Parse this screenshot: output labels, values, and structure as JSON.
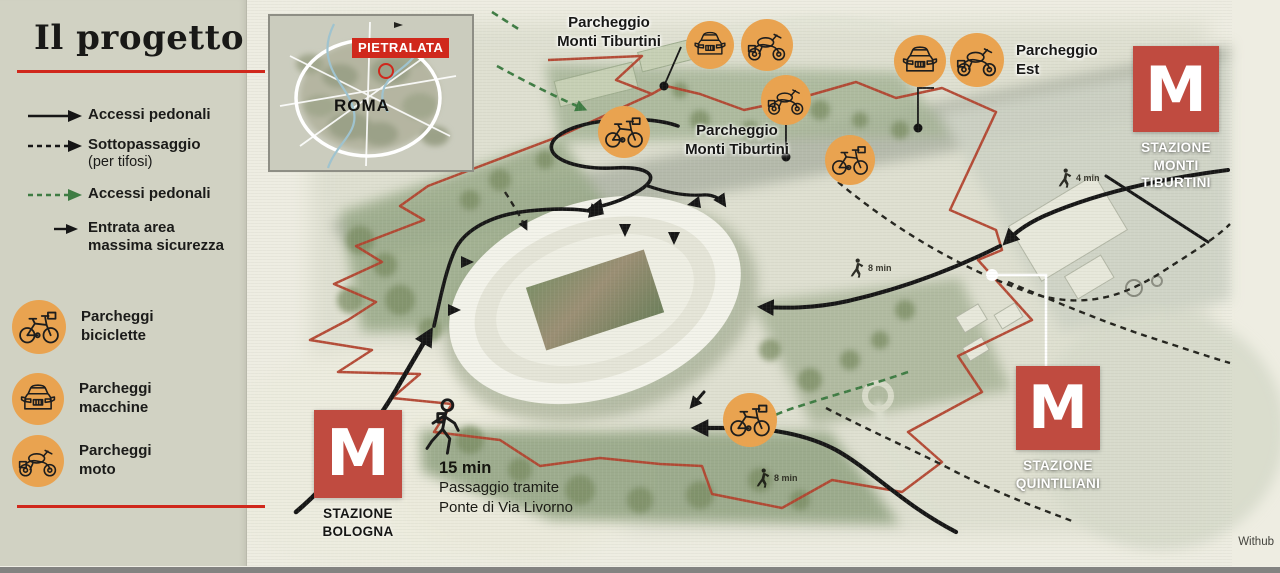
{
  "title": "Il progetto",
  "credit": "Withub",
  "colors": {
    "accent_red": "#d0281c",
    "metro_red": "#c04b40",
    "icon_orange": "#e9a350",
    "green_dash": "#3e7c43",
    "sidebar_bg": "#d1d2c3"
  },
  "legend": {
    "routes": [
      {
        "style": "solid-black-arrow",
        "label": "Accessi pedonali"
      },
      {
        "style": "dashed-black-arrow",
        "label": "Sottopassaggio",
        "sublabel": "(per tifosi)"
      },
      {
        "style": "dashed-green-arrow",
        "label": "Accessi pedonali"
      },
      {
        "style": "small-black-arrow",
        "line1": "Entrata area",
        "line2": "massima sicurezza"
      }
    ],
    "parking": [
      {
        "icon": "bicycle-icon",
        "line1": "Parcheggi",
        "line2": "biciclette"
      },
      {
        "icon": "car-icon",
        "line1": "Parcheggi",
        "line2": "macchine"
      },
      {
        "icon": "motorcycle-icon",
        "line1": "Parcheggi",
        "line2": "moto"
      }
    ]
  },
  "inset": {
    "district": "PIETRALATA",
    "city": "ROMA"
  },
  "map": {
    "labels": [
      {
        "line1": "Parcheggio",
        "line2": "Monti Tiburtini"
      },
      {
        "line1": "Parcheggio",
        "line2": "Monti Tiburtini"
      },
      {
        "line1": "Parcheggio",
        "line2": "Est"
      }
    ],
    "stations": [
      {
        "symbol": "M",
        "lines": [
          "STAZIONE",
          "MONTI",
          "TIBURTINI"
        ]
      },
      {
        "symbol": "M",
        "lines": [
          "STAZIONE",
          "QUINTILIANI"
        ]
      },
      {
        "symbol": "M",
        "lines": [
          "STAZIONE",
          "BOLOGNA"
        ]
      }
    ],
    "walk_note": {
      "time": "15 min",
      "line1": "Passaggio tramite",
      "line2": "Ponte di Via Livorno"
    },
    "walk_times": [
      "8 min",
      "4 min",
      "8 min"
    ],
    "icons": [
      "car-icon",
      "motorcycle-icon",
      "bicycle-icon",
      "motorcycle-icon",
      "bicycle-icon",
      "car-icon",
      "motorcycle-icon",
      "bicycle-icon"
    ]
  }
}
